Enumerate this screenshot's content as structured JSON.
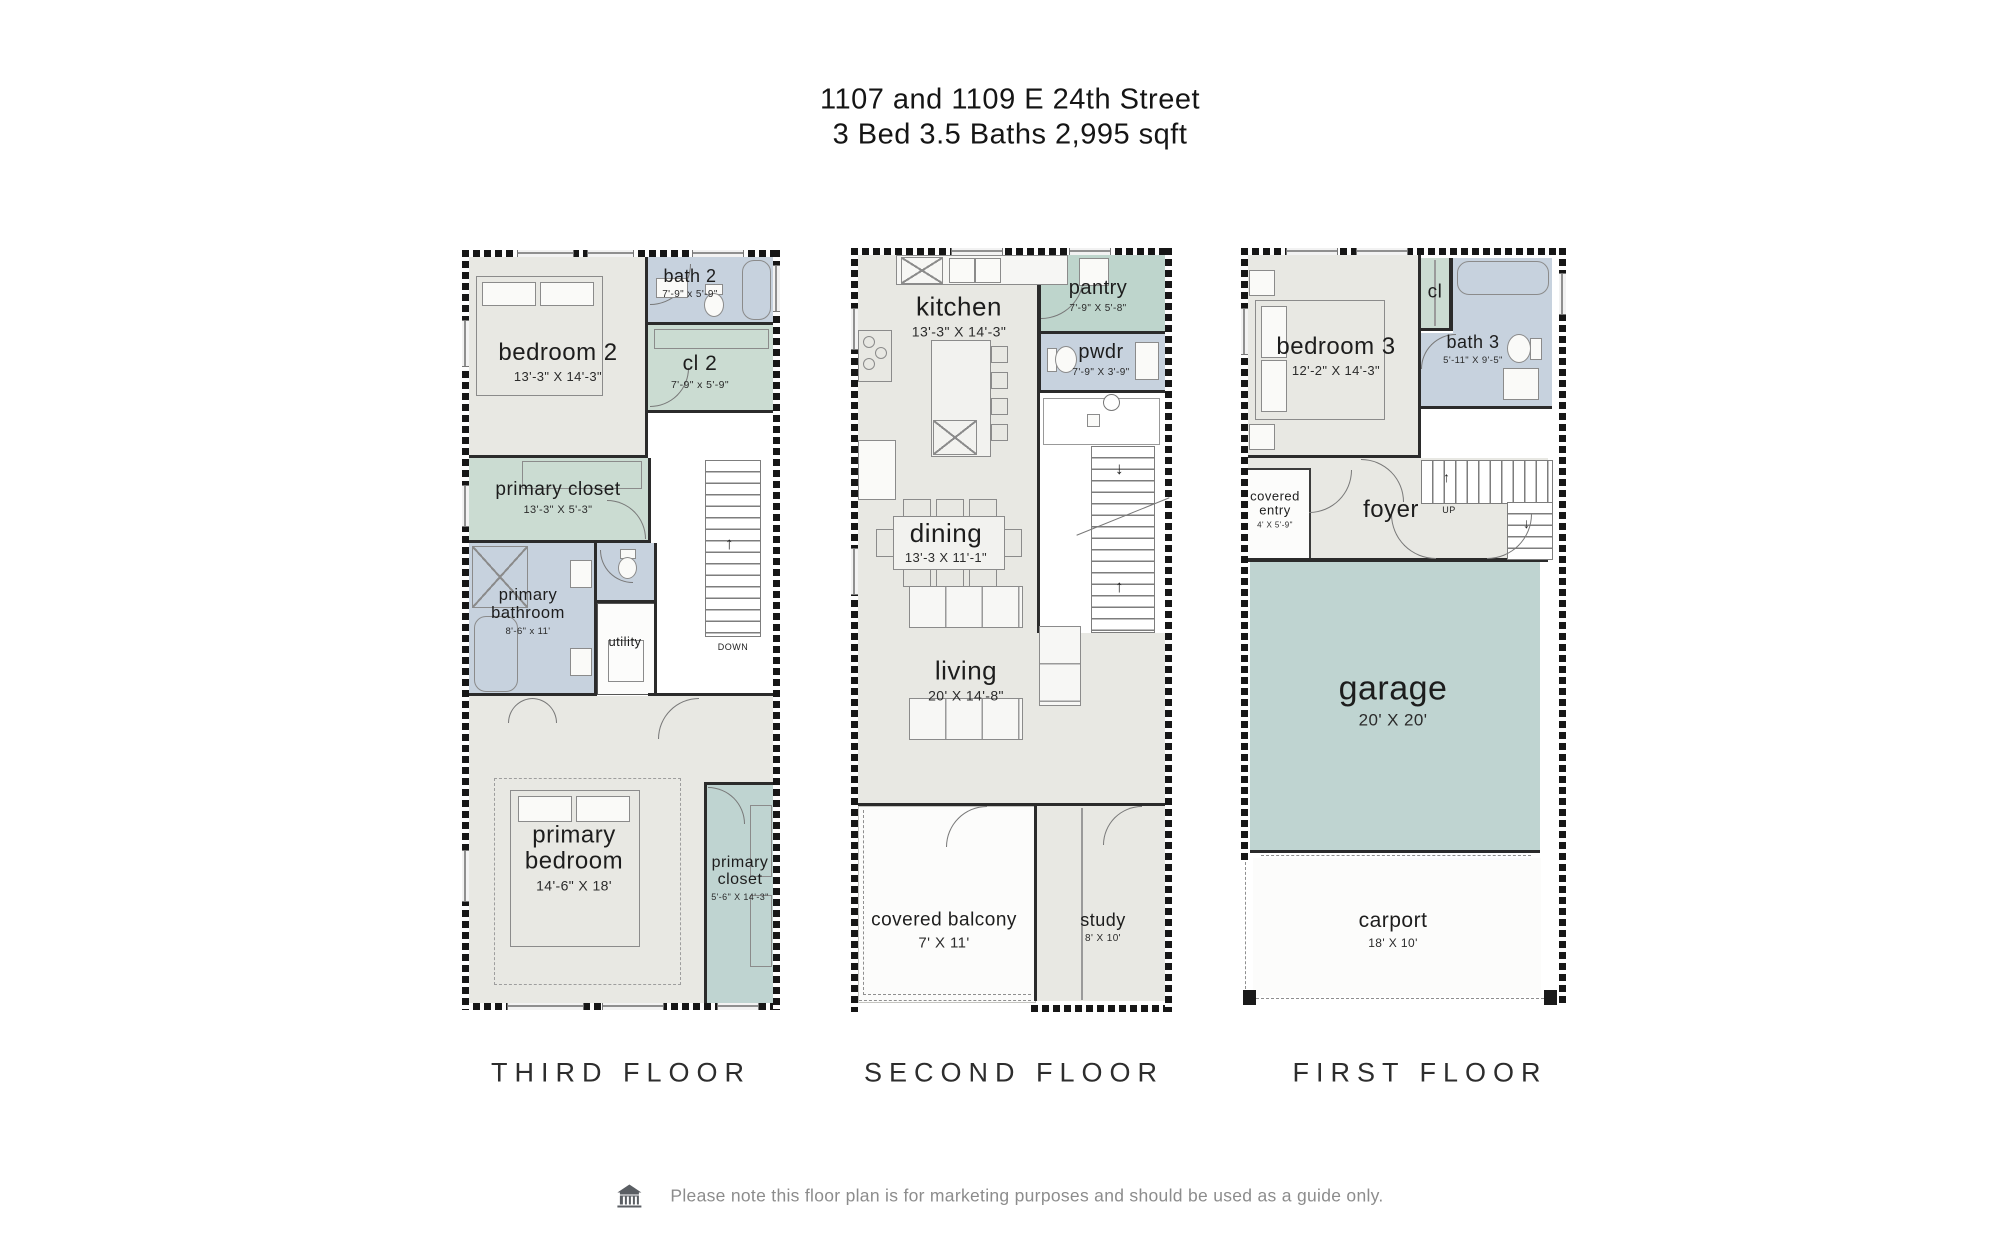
{
  "title": {
    "line1": "1107 and 1109 E 24th Street",
    "line2": "3 Bed 3.5 Baths 2,995 sqft"
  },
  "floors": {
    "third": {
      "label": "THIRD FLOOR",
      "rooms": {
        "bedroom2": {
          "name": "bedroom 2",
          "dims": "13'-3\" X 14'-3\""
        },
        "bath2": {
          "name": "bath 2",
          "dims": "7'-9\" x 5'-9\""
        },
        "cl2": {
          "name": "cl 2",
          "dims": "7'-9\" x 5'-9\""
        },
        "primary_closet_upper": {
          "name": "primary closet",
          "dims": "13'-3\" X 5'-3\""
        },
        "primary_bathroom": {
          "name": "primary bathroom",
          "dims": "8'-6\" x 11'"
        },
        "utility": {
          "name": "utility"
        },
        "primary_bedroom": {
          "name": "primary bedroom",
          "dims": "14'-6\" X 18'"
        },
        "primary_closet_lower": {
          "name": "primary closet",
          "dims": "5'-6\" X 14'-3\""
        },
        "stairs": {
          "down": "DOWN"
        }
      }
    },
    "second": {
      "label": "SECOND FLOOR",
      "rooms": {
        "kitchen": {
          "name": "kitchen",
          "dims": "13'-3\" X 14'-3\""
        },
        "pantry": {
          "name": "pantry",
          "dims": "7'-9\" X 5'-8\""
        },
        "pwdr": {
          "name": "pwdr",
          "dims": "7'-9\" X 3'-9\""
        },
        "dining": {
          "name": "dining",
          "dims": "13'-3 X 11'-1\""
        },
        "living": {
          "name": "living",
          "dims": "20' X 14'-8\""
        },
        "covered_balcony": {
          "name": "covered balcony",
          "dims": "7' X 11'"
        },
        "study": {
          "name": "study",
          "dims": "8' X 10'"
        }
      }
    },
    "first": {
      "label": "FIRST FLOOR",
      "rooms": {
        "bedroom3": {
          "name": "bedroom 3",
          "dims": "12'-2\" X 14'-3\""
        },
        "cl": {
          "name": "cl"
        },
        "bath3": {
          "name": "bath 3",
          "dims": "5'-11\" X 9'-5\""
        },
        "covered_entry": {
          "name": "covered entry",
          "dims": "4' X 5'-9\""
        },
        "foyer": {
          "name": "foyer"
        },
        "garage": {
          "name": "garage",
          "dims": "20' X 20'"
        },
        "carport": {
          "name": "carport",
          "dims": "18' X 10'"
        },
        "stairs": {
          "up": "UP"
        }
      }
    }
  },
  "icons": {
    "up_arrow": "↑",
    "down_arrow": "↓"
  },
  "footer": {
    "note": "Please note this floor plan is for marketing purposes and should be used as a guide only."
  },
  "colors": {
    "floor": "#e8e8e3",
    "bath_blue": "#c7d2de",
    "closet_green": "#cbdcd2",
    "pantry_green": "#bed5cc",
    "garage_teal": "#bfd4d1",
    "wall": "#1a1a1a",
    "footer_text": "#8c8c8c"
  }
}
